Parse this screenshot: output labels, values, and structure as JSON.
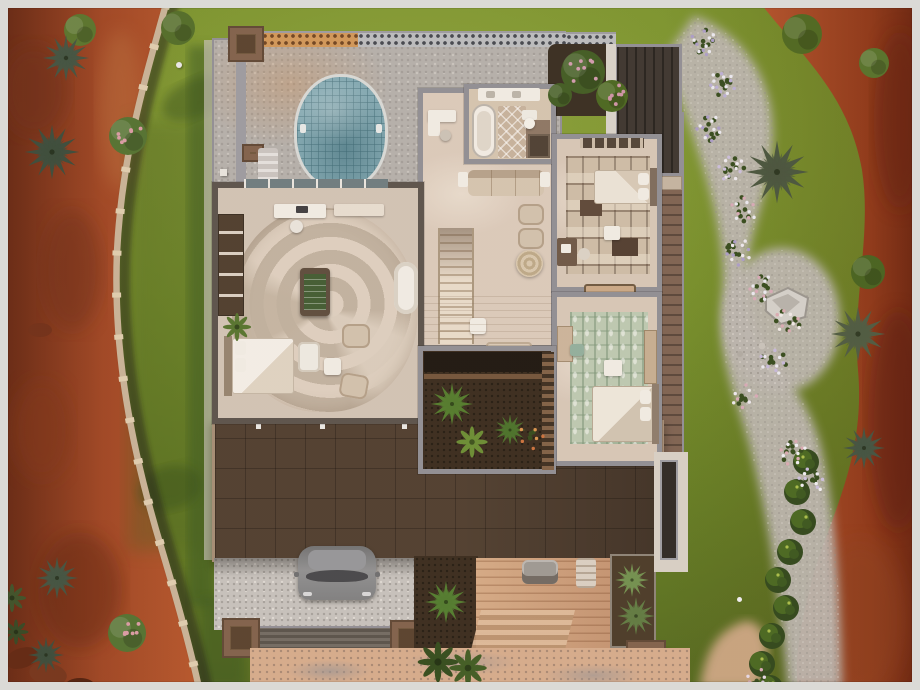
{
  "scene": {
    "type": "top-down game screenshot of a residential lot floor plan",
    "environment": [
      "red rock desert strip",
      "stone boundary wall",
      "green lawn",
      "gravel path with flowering shrubs",
      "rock garden with boulder",
      "hedge row",
      "sandy walkway"
    ],
    "house": {
      "rooms": [
        "pool patio",
        "office nook",
        "bathroom",
        "living room",
        "stair hall",
        "primary bedroom",
        "bedroom upper",
        "bedroom lower",
        "interior courtyard",
        "carport",
        "porch deck",
        "balcony"
      ],
      "exterior": [
        "flat dark roof",
        "lattice privacy fence",
        "planter boxes",
        "side deck",
        "mulch bed with palm"
      ]
    },
    "vehicle": "gray car parked in carport"
  },
  "palette": {
    "frame": "#dbdad6",
    "grass": "#74902a",
    "grassdark": "#52691e",
    "desert": "#9c4322",
    "desertdark": "#5f2310",
    "stone": "#c6b298",
    "gravelpath": "#b8b4af",
    "wallgray": "#8d8d95",
    "walldark": "#57514b",
    "floor": "#d9cabc",
    "roof": "#4c3c2f",
    "eave": "#a28b75",
    "pool": "#7fa8b4",
    "poolrim": "#d6d9d8",
    "mulch": "#36291d",
    "deckwood": "#c9a183",
    "cargray": "#85878a",
    "rugcream": "#dccfc1",
    "rugtaupe": "#bfb1a1",
    "ruggreen": "#bac8b3",
    "felt": "#3e5a32",
    "leaf": "#4a661f",
    "flowerwhite": "#e9e9f2",
    "flowerpink": "#d5a9b8",
    "flowerpurple": "#a99cc9"
  },
  "vegetation": {
    "agaves": [
      {
        "x": 66,
        "y": 58,
        "s": 1.1,
        "c": "#3e5040"
      },
      {
        "x": 52,
        "y": 152,
        "s": 1.3,
        "c": "#37493a"
      },
      {
        "x": 57,
        "y": 578,
        "s": 1.0,
        "c": "#3e5040"
      },
      {
        "x": 46,
        "y": 655,
        "s": 0.85,
        "c": "#37493a"
      },
      {
        "x": 777,
        "y": 172,
        "s": 1.5,
        "c": "#44523c"
      },
      {
        "x": 858,
        "y": 334,
        "s": 1.3,
        "c": "#4a5840"
      },
      {
        "x": 864,
        "y": 448,
        "s": 1.0,
        "c": "#3e5040"
      },
      {
        "x": 632,
        "y": 580,
        "s": 0.8,
        "c": "#6f8f4f"
      },
      {
        "x": 636,
        "y": 616,
        "s": 0.9,
        "c": "#5d7a42"
      },
      {
        "x": 452,
        "y": 404,
        "s": 1.0,
        "c": "#4f7a2c"
      },
      {
        "x": 510,
        "y": 430,
        "s": 0.75,
        "c": "#47702a"
      },
      {
        "x": 446,
        "y": 602,
        "s": 1.0,
        "c": "#4e7a2e"
      }
    ],
    "bushes": [
      {
        "x": 80,
        "y": 30,
        "r": 16,
        "c": "#55722c"
      },
      {
        "x": 178,
        "y": 28,
        "r": 17,
        "c": "#4e6b28"
      },
      {
        "x": 128,
        "y": 136,
        "r": 19,
        "c": "#4f7030",
        "f": "#d89aa6"
      },
      {
        "x": 127,
        "y": 633,
        "r": 19,
        "c": "#4f7030",
        "f": "#d89aa6"
      },
      {
        "x": 802,
        "y": 34,
        "r": 20,
        "c": "#4a661f"
      },
      {
        "x": 874,
        "y": 63,
        "r": 15,
        "c": "#52702a"
      },
      {
        "x": 868,
        "y": 272,
        "r": 17,
        "c": "#43601e"
      },
      {
        "x": 583,
        "y": 72,
        "r": 22,
        "c": "#3d5a22",
        "f": "#d09ab0"
      },
      {
        "x": 612,
        "y": 96,
        "r": 16,
        "c": "#47661f",
        "f": "#cc93a8"
      },
      {
        "x": 560,
        "y": 95,
        "r": 12,
        "c": "#3d5a22"
      }
    ],
    "ferns": [
      {
        "x": 438,
        "y": 662,
        "r": 13,
        "c": "#2f4a1c"
      },
      {
        "x": 468,
        "y": 668,
        "r": 12,
        "c": "#3c5a22"
      },
      {
        "x": 472,
        "y": 442,
        "r": 10,
        "c": "#678c33"
      },
      {
        "x": 237,
        "y": 327,
        "r": 9,
        "c": "#52722e"
      },
      {
        "x": 12,
        "y": 598,
        "r": 9,
        "c": "#3a4f28"
      },
      {
        "x": 16,
        "y": 632,
        "r": 8,
        "c": "#314522"
      }
    ],
    "hedge": [
      {
        "x": 806,
        "y": 462
      },
      {
        "x": 797,
        "y": 492
      },
      {
        "x": 803,
        "y": 522
      },
      {
        "x": 790,
        "y": 552
      },
      {
        "x": 778,
        "y": 580
      },
      {
        "x": 786,
        "y": 608
      },
      {
        "x": 772,
        "y": 636
      },
      {
        "x": 762,
        "y": 664
      },
      {
        "x": 770,
        "y": 688
      }
    ],
    "flower_clusters": [
      {
        "x": 703,
        "y": 42,
        "n": 12,
        "p": [
          "#e9e9f2",
          "#a99cc9"
        ]
      },
      {
        "x": 722,
        "y": 84,
        "n": 14,
        "p": [
          "#e9e9f2",
          "#b9aed6"
        ]
      },
      {
        "x": 709,
        "y": 128,
        "n": 12,
        "p": [
          "#e9e9f2",
          "#a99cc9"
        ]
      },
      {
        "x": 731,
        "y": 168,
        "n": 12,
        "p": [
          "#ece9f0",
          "#c9bede"
        ]
      },
      {
        "x": 744,
        "y": 210,
        "n": 10,
        "p": [
          "#e9e9f2",
          "#d5a9b8"
        ]
      },
      {
        "x": 739,
        "y": 252,
        "n": 12,
        "p": [
          "#ece9f0",
          "#a99cc9"
        ]
      },
      {
        "x": 762,
        "y": 288,
        "n": 12,
        "p": [
          "#e9e9f2",
          "#d5a9b8"
        ]
      },
      {
        "x": 788,
        "y": 322,
        "n": 10,
        "p": [
          "#efeae9",
          "#d8aab4"
        ]
      },
      {
        "x": 773,
        "y": 362,
        "n": 10,
        "p": [
          "#e9e9f2",
          "#c4b8dc"
        ]
      },
      {
        "x": 745,
        "y": 398,
        "n": 8,
        "p": [
          "#ece9f0",
          "#d5a9b8"
        ]
      },
      {
        "x": 793,
        "y": 452,
        "n": 12,
        "p": [
          "#efeff5",
          "#d8aab4"
        ]
      },
      {
        "x": 812,
        "y": 480,
        "n": 10,
        "p": [
          "#efeff5",
          "#c9bede"
        ]
      },
      {
        "x": 757,
        "y": 682,
        "n": 8,
        "p": [
          "#e5d9e9",
          "#d5a9b8"
        ]
      },
      {
        "x": 530,
        "y": 438,
        "n": 6,
        "p": [
          "#d8944e",
          "#c9703c"
        ]
      }
    ]
  }
}
